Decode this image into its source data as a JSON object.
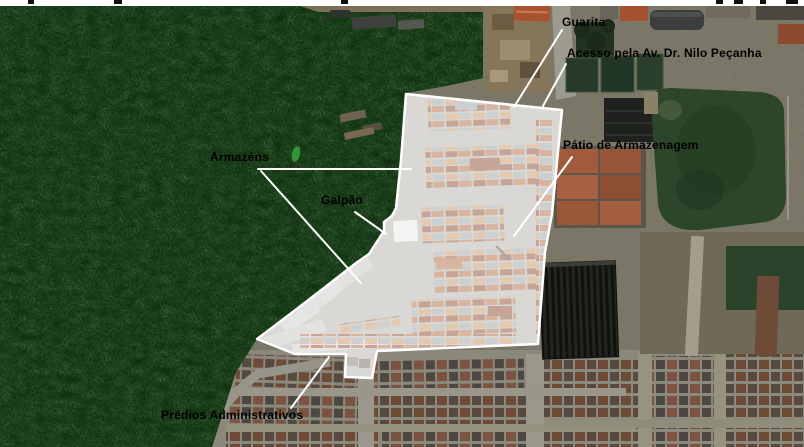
{
  "map": {
    "kind": "annotated-satellite-image",
    "colors": {
      "annotation_text": "#000000",
      "leader_line": "#ffffff",
      "site_overlay_fill": "#ffffff",
      "site_overlay_border": "#ffffff"
    }
  },
  "annotations": [
    {
      "id": "guarita",
      "label": "Guarita"
    },
    {
      "id": "acesso",
      "label": "Acesso pela Av. Dr. Nilo Peçanha"
    },
    {
      "id": "armazens",
      "label": "Armazéns"
    },
    {
      "id": "galpao",
      "label": "Galpão"
    },
    {
      "id": "patio",
      "label": "Pátio de Armazenagem"
    },
    {
      "id": "predios",
      "label": "Prédios Administrativos"
    }
  ]
}
